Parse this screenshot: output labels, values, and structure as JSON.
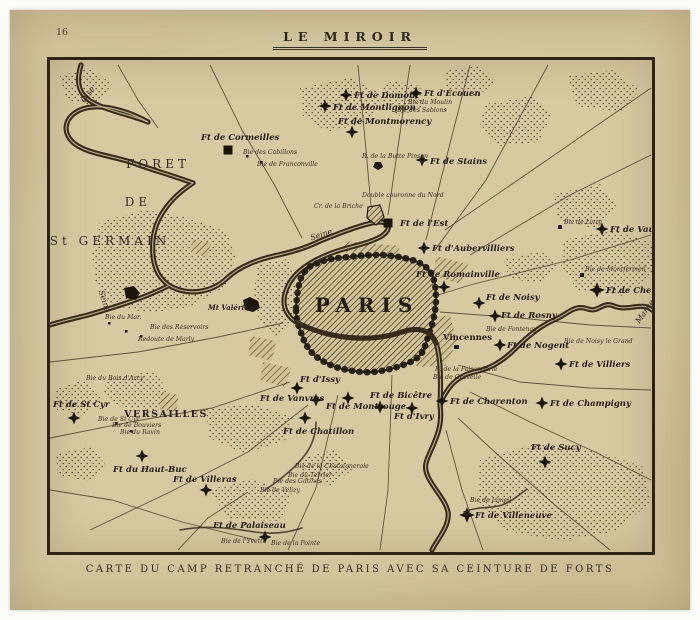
{
  "page": {
    "number": "16",
    "masthead": "LE MIROIR",
    "caption": "CARTE DU CAMP RETRANCHÉ DE PARIS AVEC SA CEINTURE DE FORTS"
  },
  "map": {
    "city_label": "PARIS",
    "towns": [
      {
        "label": "FORET",
        "x": 108,
        "y": 108,
        "cls": "region-lbl",
        "anchor": "middle"
      },
      {
        "label": "DE",
        "x": 88,
        "y": 146,
        "cls": "region-lbl",
        "anchor": "middle"
      },
      {
        "label": "St GERMAIN",
        "x": 60,
        "y": 185,
        "cls": "region-lbl",
        "anchor": "middle"
      },
      {
        "label": "VERSAILLES",
        "x": 116,
        "y": 357,
        "cls": "town-bold-lbl",
        "anchor": "middle"
      },
      {
        "label": "Vincennes",
        "x": 393,
        "y": 280,
        "cls": "town-lbl",
        "anchor": "start"
      },
      {
        "label": "Mt Valérien",
        "x": 158,
        "y": 250,
        "cls": "hill-lbl",
        "anchor": "start"
      }
    ],
    "rivers": [
      {
        "label": "Oise",
        "x": 40,
        "y": 36,
        "rot": -55
      },
      {
        "label": "Seine",
        "x": 52,
        "y": 242,
        "rot": 72
      },
      {
        "label": "Seine",
        "x": 272,
        "y": 177,
        "rot": -18
      },
      {
        "label": "Marne",
        "x": 597,
        "y": 253,
        "rot": -55
      }
    ],
    "forts": [
      {
        "label": "Ft de Cormeilles",
        "mx": 178,
        "my": 90,
        "lx": 151,
        "ly": 80,
        "shape": "square"
      },
      {
        "label": "Ft de Domont",
        "mx": 296,
        "my": 35,
        "lx": 304,
        "ly": 38
      },
      {
        "label": "Ft d'Ecouen",
        "mx": 366,
        "my": 33,
        "lx": 374,
        "ly": 36
      },
      {
        "label": "Ft de Montlignon",
        "mx": 275,
        "my": 46,
        "lx": 283,
        "ly": 50
      },
      {
        "label": "Ft de Montmorency",
        "mx": 302,
        "my": 72,
        "lx": 288,
        "ly": 64
      },
      {
        "label": "Ft de Stains",
        "mx": 372,
        "my": 100,
        "lx": 380,
        "ly": 104
      },
      {
        "label": "Ft de l'Est",
        "mx": 338,
        "my": 163,
        "lx": 350,
        "ly": 166,
        "shape": "square"
      },
      {
        "label": "Ft d'Aubervilliers",
        "mx": 374,
        "my": 188,
        "lx": 382,
        "ly": 191
      },
      {
        "label": "Ft de Romainville",
        "mx": 394,
        "my": 227,
        "lx": 366,
        "ly": 217
      },
      {
        "label": "Ft de Noisy",
        "mx": 429,
        "my": 243,
        "lx": 436,
        "ly": 240
      },
      {
        "label": "Ft de Rosny",
        "mx": 445,
        "my": 256,
        "lx": 451,
        "ly": 258
      },
      {
        "label": "Ft de Nogent",
        "mx": 450,
        "my": 285,
        "lx": 457,
        "ly": 288
      },
      {
        "label": "Ft de Villiers",
        "mx": 511,
        "my": 304,
        "lx": 519,
        "ly": 307
      },
      {
        "label": "Ft de Chelles",
        "mx": 547,
        "my": 230,
        "lx": 556,
        "ly": 233,
        "s": 1.2
      },
      {
        "label": "Ft de Vaujours",
        "mx": 552,
        "my": 169,
        "lx": 560,
        "ly": 172
      },
      {
        "label": "Ft de Champigny",
        "mx": 492,
        "my": 343,
        "lx": 500,
        "ly": 346
      },
      {
        "label": "Ft de Charenton",
        "mx": 392,
        "my": 341,
        "lx": 400,
        "ly": 344
      },
      {
        "label": "Ft d'Ivry",
        "mx": 362,
        "my": 348,
        "lx": 344,
        "ly": 359
      },
      {
        "label": "Ft de Bicêtre",
        "mx": 330,
        "my": 347,
        "lx": 320,
        "ly": 338
      },
      {
        "label": "Ft de Montrouge",
        "mx": 298,
        "my": 338,
        "lx": 276,
        "ly": 349
      },
      {
        "label": "Ft de Vanvres",
        "mx": 266,
        "my": 340,
        "lx": 210,
        "ly": 341
      },
      {
        "label": "Ft d'Issy",
        "mx": 247,
        "my": 328,
        "lx": 250,
        "ly": 322
      },
      {
        "label": "Ft de Chatillon",
        "mx": 255,
        "my": 358,
        "lx": 233,
        "ly": 374
      },
      {
        "label": "Ft de Sucy",
        "mx": 495,
        "my": 402,
        "lx": 481,
        "ly": 390
      },
      {
        "label": "Ft de Villeneuve",
        "mx": 417,
        "my": 455,
        "lx": 425,
        "ly": 458,
        "s": 1.2
      },
      {
        "label": "Ft de Palaiseau",
        "mx": 215,
        "my": 477,
        "lx": 163,
        "ly": 468
      },
      {
        "label": "Ft de Villeras",
        "mx": 156,
        "my": 430,
        "lx": 123,
        "ly": 422
      },
      {
        "label": "Ft du Haut-Buc",
        "mx": 92,
        "my": 396,
        "lx": 63,
        "ly": 412
      },
      {
        "label": "Ft de St Cyr",
        "mx": 24,
        "my": 358,
        "lx": 3,
        "ly": 347
      }
    ],
    "batteries": [
      {
        "label": "Bie du Moulin",
        "x": 358,
        "y": 44
      },
      {
        "label": "Bie des Sablons",
        "x": 347,
        "y": 52
      },
      {
        "label": "R. de la Butte Pinson",
        "x": 312,
        "y": 98
      },
      {
        "label": "Bie des Cabillons",
        "x": 193,
        "y": 94
      },
      {
        "label": "Bie de Franconville",
        "x": 207,
        "y": 106
      },
      {
        "label": "Cr. de la Briche",
        "x": 264,
        "y": 148
      },
      {
        "label": "Double couronne du Nord",
        "x": 312,
        "y": 137
      },
      {
        "label": "Bie de Livry",
        "x": 514,
        "y": 164
      },
      {
        "label": "Bie de Montfermeil",
        "x": 535,
        "y": 211
      },
      {
        "label": "Bie de Fontenay",
        "x": 436,
        "y": 271
      },
      {
        "label": "Bie de Noisy le Grand",
        "x": 514,
        "y": 283
      },
      {
        "label": "R. de la Faisanderie",
        "x": 385,
        "y": 311
      },
      {
        "label": "Bie de Gravelle",
        "x": 383,
        "y": 319
      },
      {
        "label": "Bie de Limeil",
        "x": 420,
        "y": 442
      },
      {
        "label": "Bie de l'Yvette",
        "x": 171,
        "y": 483
      },
      {
        "label": "Bie de la Pointe",
        "x": 221,
        "y": 485
      },
      {
        "label": "Bie de la Chataigneraie",
        "x": 245,
        "y": 408
      },
      {
        "label": "Bie du Terrier",
        "x": 238,
        "y": 417
      },
      {
        "label": "Bie des Gatines",
        "x": 223,
        "y": 423
      },
      {
        "label": "Bie de Vélizy",
        "x": 210,
        "y": 432
      },
      {
        "label": "Bie de Bouviers",
        "x": 62,
        "y": 367
      },
      {
        "label": "Bie de St Cyr",
        "x": 48,
        "y": 361
      },
      {
        "label": "Bie du Ravin",
        "x": 70,
        "y": 374
      },
      {
        "label": "Bie du Bois d'Arcy",
        "x": 36,
        "y": 320
      },
      {
        "label": "Bie du Mar.",
        "x": 55,
        "y": 259
      },
      {
        "label": "Bie des Réservoirs",
        "x": 100,
        "y": 269
      },
      {
        "label": "Redoute de Marly",
        "x": 88,
        "y": 281
      }
    ]
  }
}
